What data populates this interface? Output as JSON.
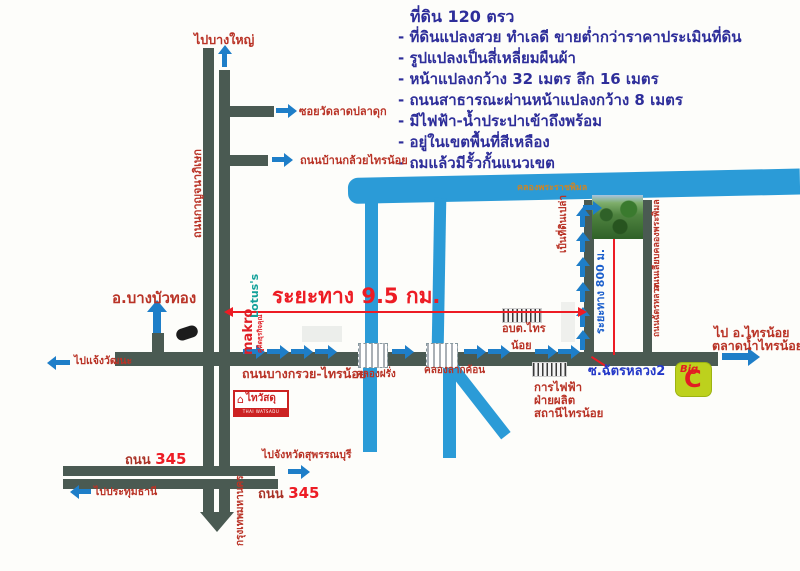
{
  "info": {
    "title": "ที่ดิน 120 ตรว",
    "lines": [
      "- ที่ดินแปลงสวย ทำเลดี ขายต่ำกว่าราคาประเมินที่ดิน",
      "- รูปแปลงเป็นสี่เหลี่ยมผืนผ้า",
      "- หน้าแปลงกว้าง 32 เมตร ลึก 16 เมตร",
      "- ถนนสาธารณะผ่านหน้าแปลงกว้าง 8 เมตร",
      "- มีไฟฟ้า-น้ำประปาเข้าถึงพร้อม",
      "- อยู่ในเขตพื้นที่สีเหลือง",
      "- ถมแล้วมีรั้วกั้นแนวเขต"
    ]
  },
  "labels": {
    "to_bang_yai": "ไปบางใหญ่",
    "kanchanaphisek_rd": "ถนนกาญจนาภิเษก",
    "soi_wat_lat_pla_duk": "ซอยวัดลาดปลาดุก",
    "ban_kluai_sai_noi_rd": "ถนนบ้านกล้วยไทรน้อย",
    "bang_bua_thong": "อ.บางบัวทอง",
    "to_chaeng_watthana": "ไปแจ้งวัฒนะ",
    "bang_kruai_sai_noi_rd": "ถนนบางกรวย-ไทรน้อย",
    "khlong_farang": "คลองฝรั่ง",
    "khlong_lak_khon": "คลองลากค้อน",
    "distance_9_5km": "ระยะทาง 9.5 กม.",
    "khlong_phra_racha_phimon": "คลองพระราชพิมล",
    "sao_sai_noi_1": "อบต.ไทร",
    "sao_sai_noi_2": "น้อย",
    "empty_land": "เป็นที่ดินเปล่า",
    "distance_800m": "ระยะทาง 800 ม.",
    "road_along_khlong": "ถนนเลียบคลองพระพิมล",
    "chat_luang_rd": "ถนนฉัตรหลวง",
    "soi_chat_luang_2": "ซ.ฉัตรหลวง2",
    "egat_1": "การไฟฟ้า",
    "egat_2": "ฝ่ายผลิต",
    "egat_3": "สถานีไทรน้อย",
    "to_sai_noi_1": "ไป อ.ไทรน้อย",
    "to_sai_noi_2": "ตลาดน้ำไทรน้อย",
    "road_345_word": "ถนน",
    "road_345_num": "345",
    "to_suphanburi": "ไปจังหวัดสุพรรณบุรี",
    "to_pathum_thani": "ไปประทุมธานี",
    "to_bangkok": "กรุงเทพมหานคร"
  },
  "logos": {
    "lotus": "Lotus's",
    "makro": "makro",
    "makro_tagline": "คู่คิดธุรกิจคุณ",
    "thaiwatsadu": "ไทวัสดุ",
    "thaiwatsadu_sub": "THAI WATSADU",
    "bigc_big": "Big",
    "bigc_c": "C"
  },
  "colors": {
    "road": "#4a5a52",
    "water": "#2b9bd7",
    "arrow": "#1e7ec8",
    "label_red": "#b93326",
    "highlight_red": "#ed1c24",
    "info_navy": "#2e2e9a",
    "soi_blue": "#2438c8",
    "canal_orange": "#c8862c"
  }
}
